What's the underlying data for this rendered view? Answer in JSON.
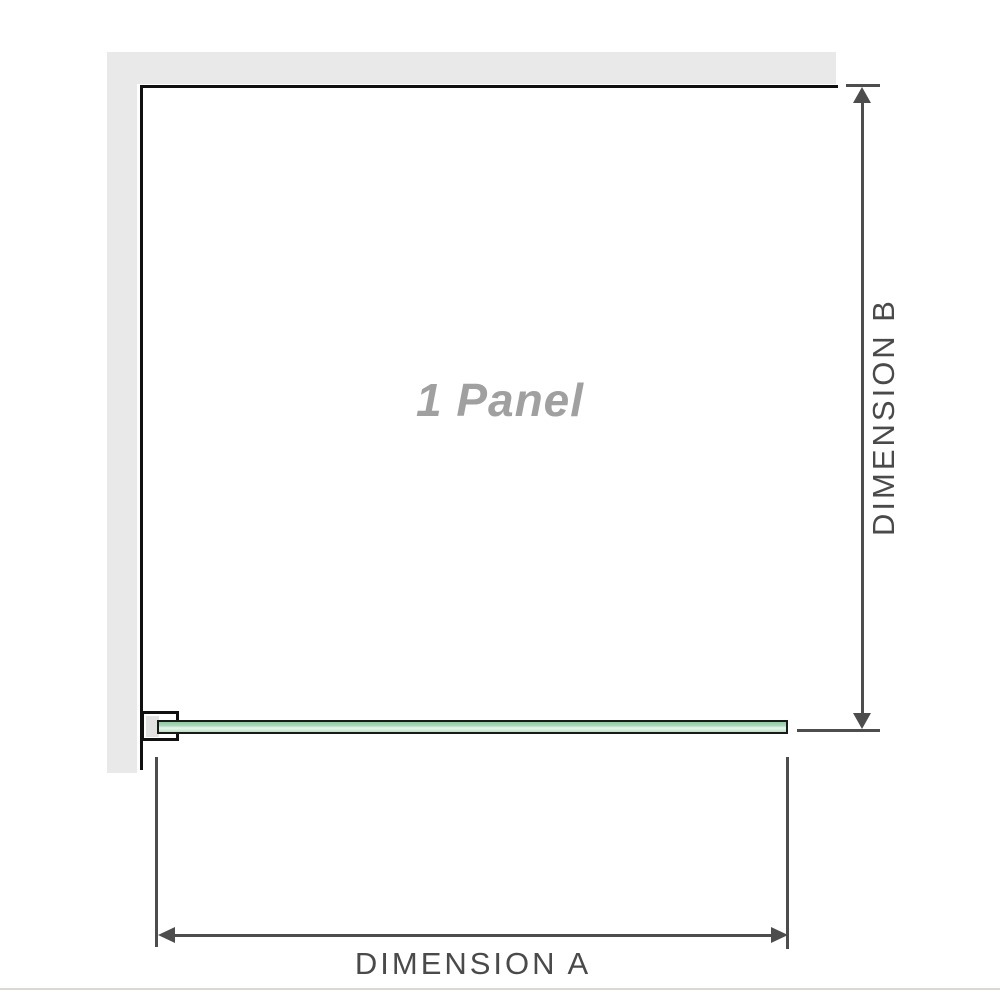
{
  "diagram": {
    "title": "1 Panel",
    "panel_label": "1 Panel",
    "dimension_a_label": "DIMENSION A",
    "dimension_b_label": "DIMENSION B"
  },
  "icons": {
    "arrow_up": "triangle-up",
    "arrow_down": "triangle-down",
    "arrow_left": "triangle-left",
    "arrow_right": "triangle-right"
  },
  "colors": {
    "wall_fill": "#e9e9e9",
    "panel_outline": "#101010",
    "glass_green": "#a6d8b5",
    "glass_highlight": "#e9f6ee",
    "glass_border": "#1a1a1a",
    "bracket_fill": "#ffffff",
    "bracket_inner": "#e2e2e2",
    "dimension_line": "#4d4d4d",
    "dimension_text": "#4a4a4a",
    "watermark_text": "#a0a0a0",
    "baseline": "#dcd8d1",
    "background": "#ffffff"
  }
}
